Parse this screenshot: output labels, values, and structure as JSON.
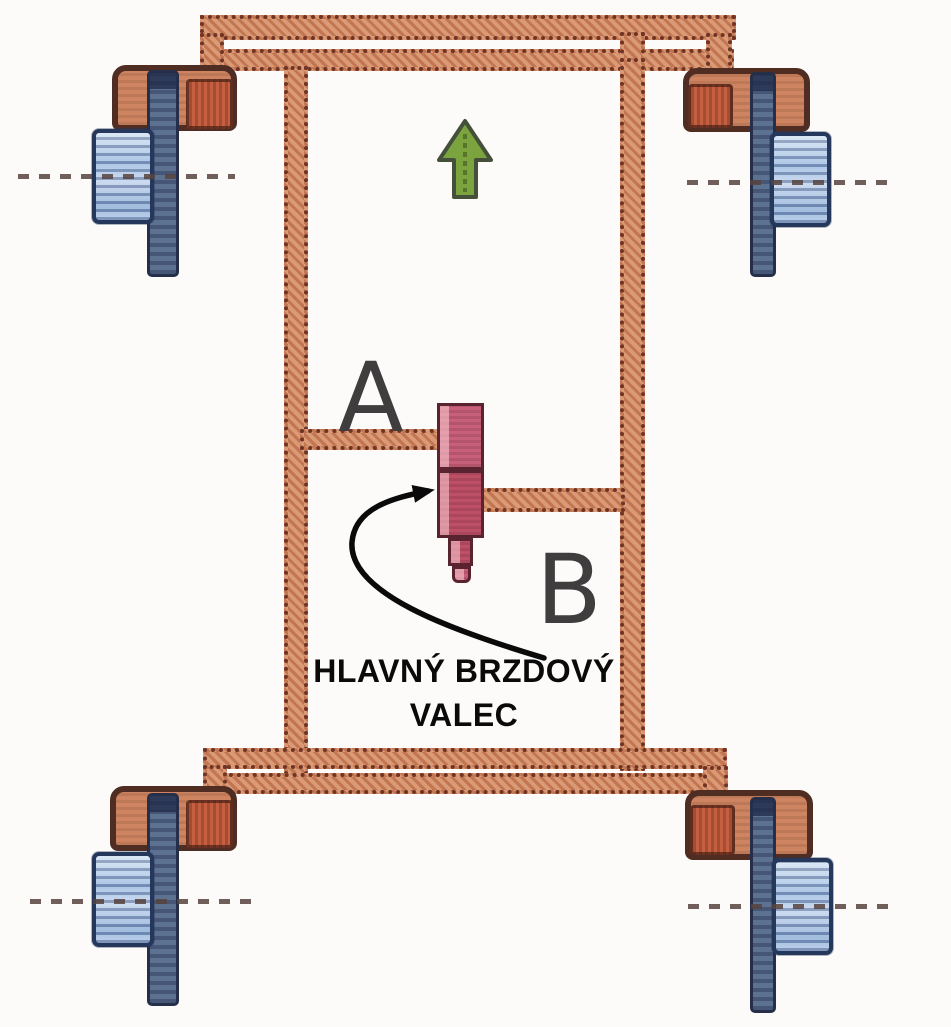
{
  "diagram": {
    "annotation": {
      "line1": "HLAVNÝ BRZDOVÝ",
      "line2": "VALEC"
    },
    "labels": {
      "circuit_a": "A",
      "circuit_b": "B"
    },
    "icons": {
      "direction_arrow": "up-arrow-icon",
      "pointer": "curved-arrow-icon"
    },
    "colors": {
      "pipe": "#d2835a",
      "pipe_edge": "#6f3424",
      "drum": "#a7c4e6",
      "drum_edge": "#26375c",
      "shaft": "#5d7191",
      "shaft_edge": "#252f49",
      "bracket": "#cf8461",
      "bracket_block": "#c65f40",
      "bracket_edge": "#4f2d22",
      "cylinder_top": "#c9607a",
      "cylinder_bottom": "#bd4f66",
      "cylinder_edge": "#5a2330",
      "arrow_green": "#7ca43e",
      "arrow_green_edge": "#44503a",
      "label_color": "#3f3d3d",
      "annotation_color": "#0a0a0a",
      "axle_color": "#57433e"
    }
  }
}
